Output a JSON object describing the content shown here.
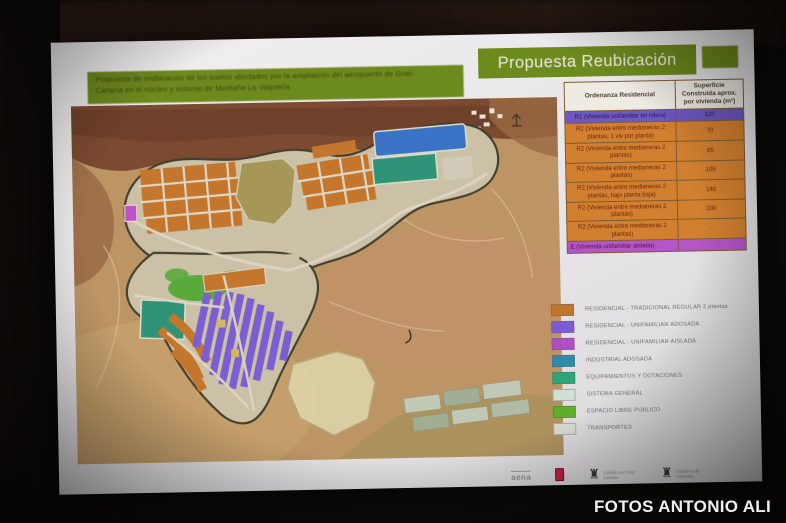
{
  "photo": {
    "watermark": "FOTOS ANTONIO ALI"
  },
  "slide": {
    "banner": {
      "line1": "Propuesta de reubicación de los suelos afectados por la ampliación del aeropuerto de Gran",
      "line2": "Canaria en el núcleo y entorno de Montaña La Vaquería"
    },
    "title": "Propuesta Reubicación",
    "table": {
      "headers": [
        "Ordenanza Residencial",
        "Superficie Construida aprox. por vivienda (m²)"
      ],
      "rows": [
        {
          "label": "R1 (Vivienda unifamiliar en hilera)",
          "value": "120",
          "type": "purple"
        },
        {
          "label": "R2 (Vivienda entre medianeras 2 plantas, 1 viv por planta)",
          "value": "70",
          "type": "orange"
        },
        {
          "label": "R2 (Vivienda entre medianeras 2 plantas)",
          "value": "85",
          "type": "orange"
        },
        {
          "label": "R2 (Vivienda entre medianeras 2 plantas)",
          "value": "105",
          "type": "orange"
        },
        {
          "label": "R2 (Vivienda entre medianeras 2 plantas, bajo planta baja)",
          "value": "140",
          "type": "orange"
        },
        {
          "label": "R2 (Vivienda entre medianeras 2 plantas)",
          "value": "200",
          "type": "orange"
        },
        {
          "label": "R2 (Vivienda entre medianeras 2 plantas)",
          "value": "-",
          "type": "orange"
        },
        {
          "label": "E (Vivienda unifamiliar aislada)",
          "value": "",
          "type": "magenta"
        }
      ]
    },
    "legend": {
      "items": [
        {
          "label": "RESIDENCIAL - TRADICIONAL REGULAR 2 plantas",
          "color": "#c0762d"
        },
        {
          "label": "RESIDENCIAL - UNIFAMILIAR ADOSADA",
          "color": "#7a5cd6"
        },
        {
          "label": "RESIDENCIAL - UNIFAMILIAR AISLADA",
          "color": "#b04ec4"
        },
        {
          "label": "INDUSTRIAL ADOSADA",
          "color": "#2f8ca8"
        },
        {
          "label": "EQUIPAMIENTOS Y DOTACIONES",
          "color": "#2fa477"
        },
        {
          "label": "SISTEMA GENERAL",
          "color": "#cfe0d4"
        },
        {
          "label": "ESPACIO LIBRE PÚBLICO",
          "color": "#5fae2a"
        },
        {
          "label": "TRANSPORTES",
          "color": "#d8d8d0"
        }
      ]
    },
    "logos": [
      {
        "kind": "aena",
        "caption": "aena"
      },
      {
        "kind": "shield",
        "caption": ""
      },
      {
        "kind": "crest",
        "caption": "Cabildo de Gran Canaria"
      },
      {
        "kind": "crest",
        "caption": "Gobierno de Canarias"
      }
    ]
  }
}
